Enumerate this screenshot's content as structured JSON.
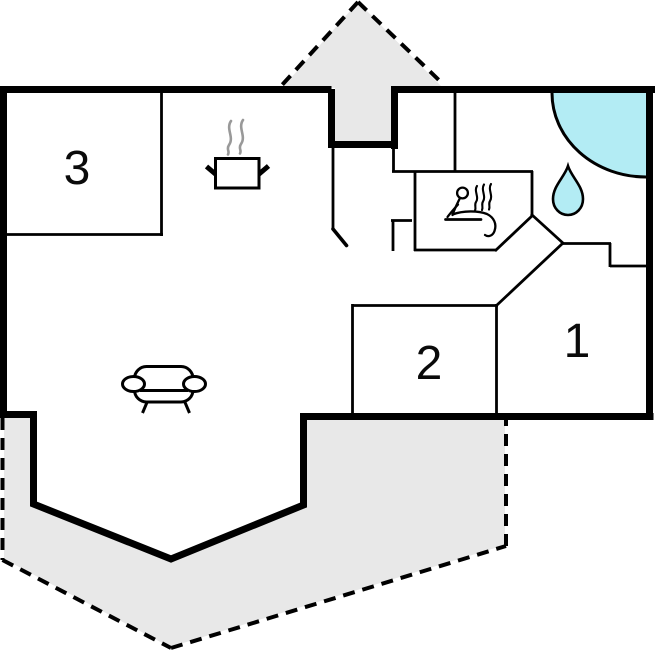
{
  "rooms": [
    {
      "id": "room-1",
      "label": "1"
    },
    {
      "id": "room-2",
      "label": "2"
    },
    {
      "id": "room-3",
      "label": "3"
    }
  ],
  "icons": [
    {
      "name": "cooking-pot-icon"
    },
    {
      "name": "steam-icon"
    },
    {
      "name": "sauna-person-icon"
    },
    {
      "name": "water-drop-icon"
    },
    {
      "name": "corner-bathtub-icon"
    },
    {
      "name": "sofa-icon"
    }
  ],
  "colors": {
    "wall": "#000000",
    "terrace": "#e8e8e8",
    "water": "#b3ecf4",
    "steam": "#999999",
    "background": "#ffffff"
  }
}
